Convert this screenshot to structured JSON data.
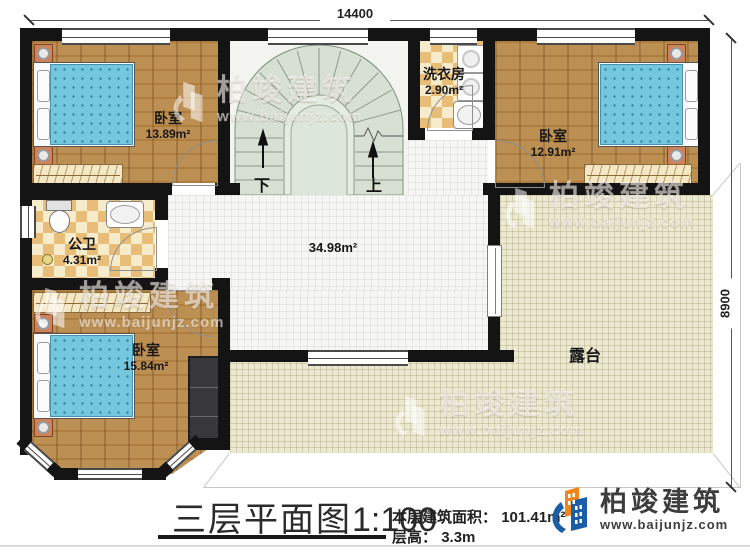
{
  "colors": {
    "wall": "#141414",
    "wood_floor": "#b9894a",
    "tile_light": "#f6ebcb",
    "tile_dark": "#e7bd77",
    "hall_floor": "#f6f7f4",
    "terrace_floor": "#ebe9d2",
    "stair_fill": "#d8e0d4",
    "mattress_blue": "#75c7de",
    "brand_blue": "#1b5ea6",
    "brand_orange": "#f08519"
  },
  "dimensions": {
    "top": "14400",
    "right": "8900"
  },
  "rooms": [
    {
      "id": "bedroom-top-left",
      "name": "卧室",
      "area": "13.89m²"
    },
    {
      "id": "laundry",
      "name": "洗衣房",
      "area": "2.90m²"
    },
    {
      "id": "bedroom-top-right",
      "name": "卧室",
      "area": "12.91m²"
    },
    {
      "id": "bathroom",
      "name": "公卫",
      "area": "4.31m²"
    },
    {
      "id": "bedroom-bottom",
      "name": "卧室",
      "area": "15.84m²"
    },
    {
      "id": "hall",
      "name": "",
      "area": "34.98m²"
    },
    {
      "id": "terrace",
      "name": "露台",
      "area": ""
    }
  ],
  "stairs": {
    "down_label": "下",
    "up_label": "上"
  },
  "watermark": {
    "name": "柏竣建筑",
    "url": "www.baijunjz.com"
  },
  "title_block": {
    "title": "三层平面图",
    "scale": "1:100",
    "area_label": "本层建筑面积：",
    "area_value": "101.41m²",
    "floor_height_label": "层高：",
    "floor_height_value": "3.3m"
  },
  "brand": {
    "name": "柏竣建筑",
    "url": "www.baijunjz.com"
  }
}
